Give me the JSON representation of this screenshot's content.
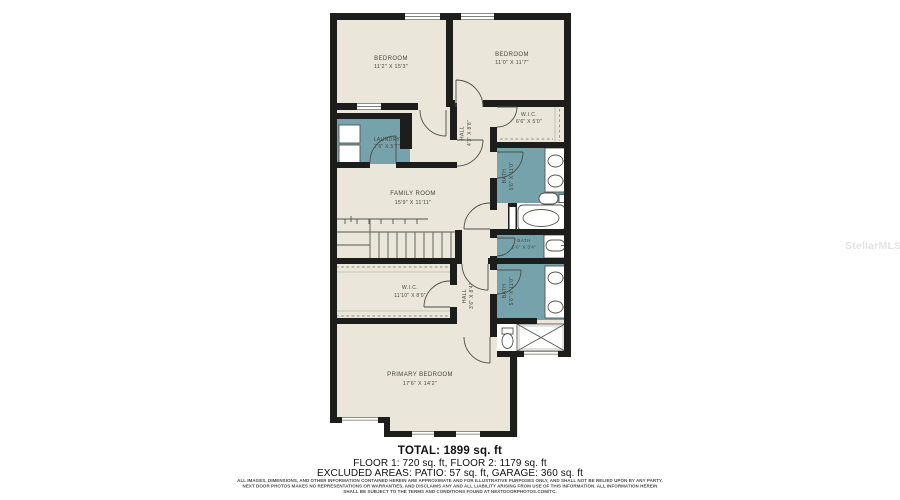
{
  "watermark": "StellarMLS",
  "colors": {
    "wall": "#1d1d1b",
    "floor": "#eae7da",
    "wet_room": "#76a2ab",
    "page": "#ffffff"
  },
  "rooms": {
    "bedroom_left": {
      "name": "BEDROOM",
      "dims": "11'2\" X 15'3\""
    },
    "bedroom_right": {
      "name": "BEDROOM",
      "dims": "11'0\" X 11'7\""
    },
    "wic_small": {
      "name": "W.I.C.",
      "dims": "6'6\" X 5'0\""
    },
    "laundry": {
      "name": "LAUNDRY",
      "dims": "7'6\" X 5'7\""
    },
    "hall_upper": {
      "name": "HALL",
      "dims": "4'3\" X 8'8\""
    },
    "family_room": {
      "name": "FAMILY ROOM",
      "dims": "15'9\" X 11'11\""
    },
    "bath_hall": {
      "name": "BATH",
      "dims": "5'6\" X 11'0\""
    },
    "bath_small": {
      "name": "BATH",
      "dims": "5'6\" X 3'4\""
    },
    "wic_primary": {
      "name": "W.I.C.",
      "dims": "11'10\" X 8'0\""
    },
    "hall_lower": {
      "name": "HALL",
      "dims": "3'6\" X 8'4\""
    },
    "bath_primary": {
      "name": "BATH",
      "dims": "5'6\" X 11'0\""
    },
    "primary_bedroom": {
      "name": "PRIMARY BEDROOM",
      "dims": "17'6\" X 14'2\""
    }
  },
  "summary": {
    "total": "TOTAL: 1899 sq. ft",
    "floors": "FLOOR 1: 720 sq. ft, FLOOR 2: 1179 sq. ft",
    "excluded": "EXCLUDED AREAS: PATIO: 57 sq. ft, GARAGE: 360 sq. ft"
  },
  "disclaimer": {
    "line1": "ALL IMAGES, DIMENSIONS, AND OTHER INFORMATION CONTAINED HEREIN ARE APPROXIMATE AND FOR ILLUSTRATIVE PURPOSES ONLY, AND SHALL NOT BE RELIED UPON BY ANY PARTY.",
    "line2": "NEXT DOOR PHOTOS MAKES NO REPRESENTATIONS OR WARRANTIES, AND DISCLAIMS ANY AND ALL LIABILITY ARISING FROM USE OF THIS INFORMATION. ALL INFORMATION HEREIN",
    "line3": "SHALL BE SUBJECT TO THE TERMS AND CONDITIONS FOUND AT NEXTDOORPHOTOS.COM/TC."
  }
}
